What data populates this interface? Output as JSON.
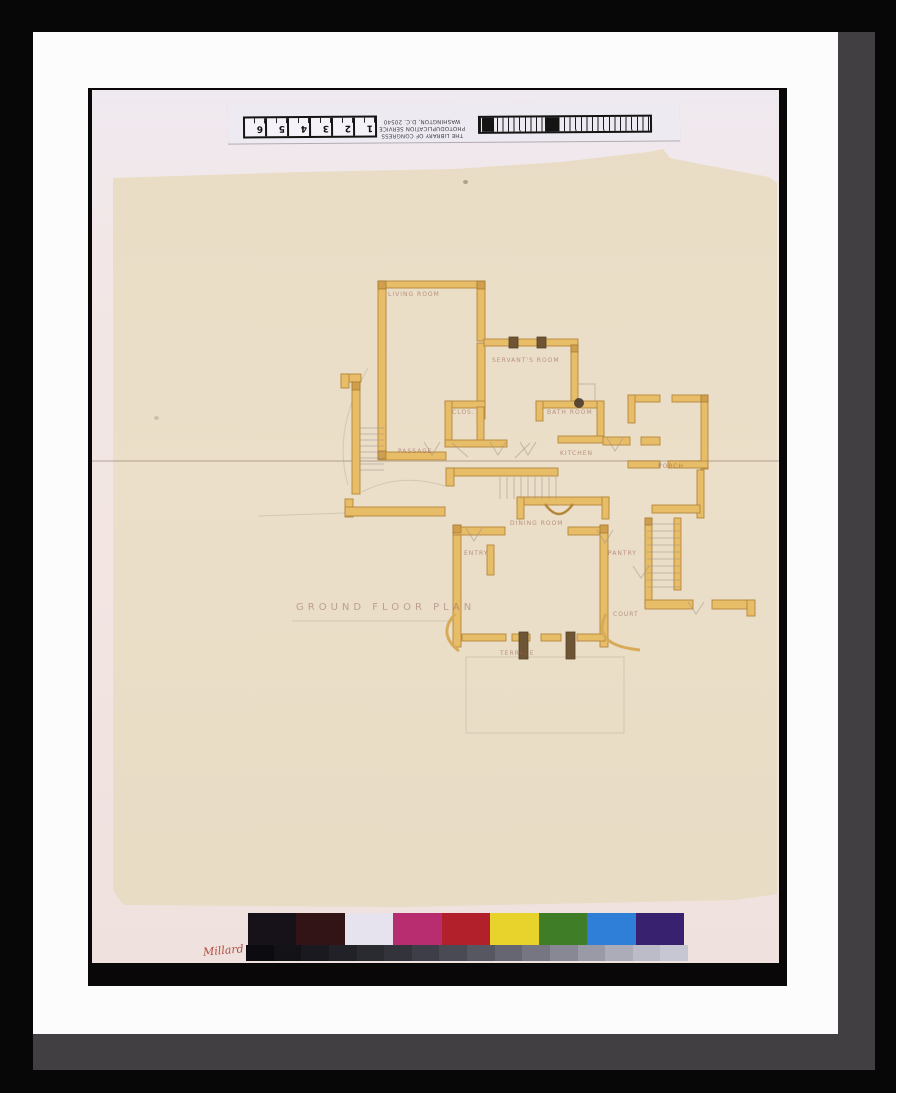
{
  "ruler": {
    "line1": "THE LIBRARY OF CONGRESS",
    "line2": "PHOTODUPLICATION SERVICE",
    "line3": "WASHINGTON, D.C. 20540",
    "inch_numbers": [
      "1",
      "2",
      "3",
      "4",
      "5",
      "6"
    ]
  },
  "plan": {
    "title": "GROUND FLOOR PLAN",
    "labels": [
      {
        "id": "living-room",
        "text": "LIVING ROOM",
        "x": 388,
        "y": 291
      },
      {
        "id": "servants-room",
        "text": "SERVANT'S ROOM",
        "x": 492,
        "y": 357
      },
      {
        "id": "closet",
        "text": "CLOS.",
        "x": 452,
        "y": 409
      },
      {
        "id": "bath-room",
        "text": "BATH ROOM",
        "x": 547,
        "y": 409
      },
      {
        "id": "passage",
        "text": "PASSAGE",
        "x": 398,
        "y": 448
      },
      {
        "id": "kitchen",
        "text": "KITCHEN",
        "x": 560,
        "y": 450
      },
      {
        "id": "porch",
        "text": "PORCH",
        "x": 658,
        "y": 463
      },
      {
        "id": "dining-room",
        "text": "DINING ROOM",
        "x": 510,
        "y": 520
      },
      {
        "id": "entry",
        "text": "ENTRY",
        "x": 464,
        "y": 550
      },
      {
        "id": "pantry",
        "text": "PANTRY",
        "x": 608,
        "y": 550
      },
      {
        "id": "court",
        "text": "COURT",
        "x": 613,
        "y": 611
      },
      {
        "id": "terrace",
        "text": "TERRACE",
        "x": 500,
        "y": 650
      }
    ]
  },
  "annotation": {
    "text": "Millard"
  },
  "color_bar": {
    "patches": [
      "#17121a",
      "#321316",
      "#e7e3ee",
      "#b82d70",
      "#b2202b",
      "#e8d22c",
      "#3f7e26",
      "#2f7ed8",
      "#38216f"
    ],
    "grays": [
      "#0b0b10",
      "#121217",
      "#19191f",
      "#212127",
      "#2a2a31",
      "#33333c",
      "#3e3e48",
      "#4a4a55",
      "#575762",
      "#666672",
      "#767683",
      "#888894",
      "#9a9aa6",
      "#acacb8",
      "#bcbcc8",
      "#c6c7d3"
    ]
  }
}
